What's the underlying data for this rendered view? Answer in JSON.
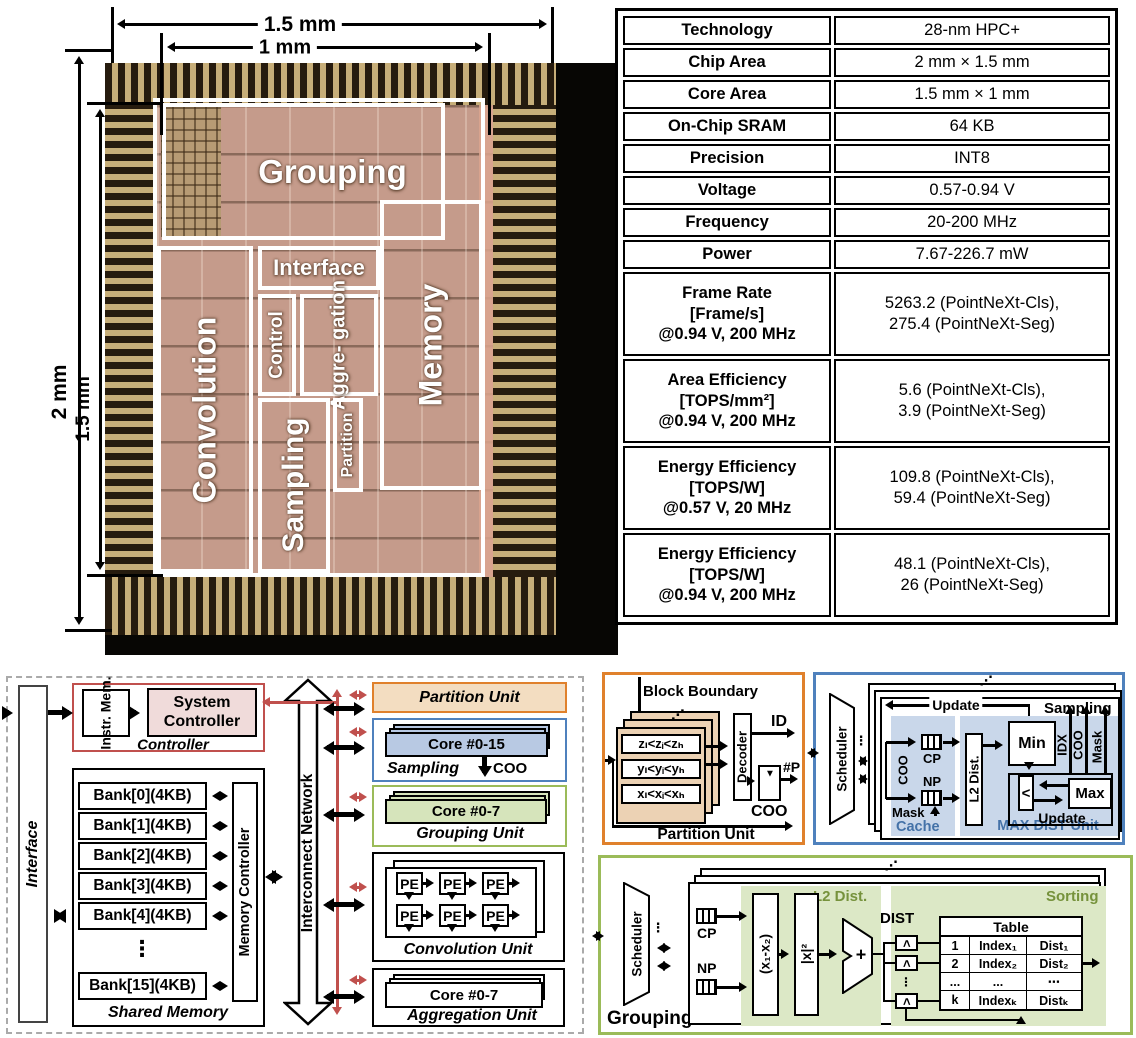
{
  "colors": {
    "red": "#c0504d",
    "orange": "#e0812c",
    "blue": "#4f81bd",
    "green": "#9bbb59",
    "tan_fill": "#ecd2b4",
    "partition_fill": "#f3ddc1",
    "blue_fill": "#b8c9e3",
    "green_fill": "#d6e4bb",
    "pink_fill": "#f0dbda",
    "shade_blue": "#c9d7ea",
    "shade_green": "#dce8c6",
    "label_green": "#76923c",
    "label_blue": "#4472a8"
  },
  "die_photo": {
    "dim_top_outer": "1.5 mm",
    "dim_top_inner": "1 mm",
    "dim_left_outer": "2 mm",
    "dim_left_inner": "1.5 mm",
    "regions": {
      "grouping": "Grouping",
      "interface": "Interface",
      "control": "Control",
      "aggregation": "Aggre-\ngation",
      "convolution": "Convolution",
      "sampling": "Sampling",
      "partition": "Partition",
      "memory": "Memory"
    }
  },
  "spec_table": {
    "rows": [
      {
        "label": "Technology",
        "value": "28-nm HPC+"
      },
      {
        "label": "Chip Area",
        "value": "2 mm × 1.5 mm"
      },
      {
        "label": "Core Area",
        "value": "1.5 mm × 1 mm"
      },
      {
        "label": "On-Chip SRAM",
        "value": "64 KB"
      },
      {
        "label": "Precision",
        "value": "INT8"
      },
      {
        "label": "Voltage",
        "value": "0.57-0.94 V"
      },
      {
        "label": "Frequency",
        "value": "20-200 MHz"
      },
      {
        "label": "Power",
        "value": "7.67-226.7 mW"
      },
      {
        "label": "Frame Rate\n[Frame/s]\n@0.94 V, 200 MHz",
        "value": "5263.2 (PointNeXt-Cls),\n275.4 (PointNeXt-Seg)"
      },
      {
        "label": "Area Efficiency\n[TOPS/mm²]\n@0.94 V, 200 MHz",
        "value": "5.6 (PointNeXt-Cls),\n3.9 (PointNeXt-Seg)"
      },
      {
        "label": "Energy Efficiency\n[TOPS/W]\n@0.57 V, 20 MHz",
        "value": "109.8 (PointNeXt-Cls),\n59.4 (PointNeXt-Seg)"
      },
      {
        "label": "Energy Efficiency\n[TOPS/W]\n@0.94 V, 200 MHz",
        "value": "48.1 (PointNeXt-Cls),\n26 (PointNeXt-Seg)"
      }
    ]
  },
  "arch": {
    "interface": "Interface",
    "controller": {
      "instr_mem": "Instr.\nMem.",
      "system_controller": "System\nController",
      "label": "Controller"
    },
    "shared_memory": {
      "banks": [
        "Bank[0](4KB)",
        "Bank[1](4KB)",
        "Bank[2](4KB)",
        "Bank[3](4KB)",
        "Bank[4](4KB)"
      ],
      "dots": "⋮",
      "last_bank": "Bank[15](4KB)",
      "memory_controller": "Memory Controller",
      "label": "Shared Memory"
    },
    "interconnect": "Interconnect Network",
    "partition_unit": "Partition Unit",
    "sampling": {
      "core": "Core #0-15",
      "label": "Sampling",
      "coo": "COO"
    },
    "grouping": {
      "core": "Core #0-7",
      "label": "Grouping Unit"
    },
    "convolution": {
      "pe": "PE",
      "label": "Convolution Unit"
    },
    "aggregation": {
      "core": "Core #0-7",
      "label": "Aggregation Unit"
    }
  },
  "partition_detail": {
    "title": "Block Boundary",
    "card_dots": "⋰",
    "rows": [
      "zₗ<zᵢ<zₕ",
      "yₗ<yᵢ<yₕ",
      "xₗ<xᵢ<xₕ"
    ],
    "decoder": "Decoder",
    "mid_dots": "⋮",
    "id": "ID",
    "hash_p": "#P",
    "tri": "▼",
    "coo": "COO",
    "label": "Partition Unit"
  },
  "sampling_detail": {
    "scheduler": "Scheduler",
    "dots": "⋮",
    "card_dots": "⋰",
    "update_top": "Update",
    "title": "Sampling",
    "coo": "COO",
    "cp": "CP",
    "np": "NP",
    "mask": "Mask",
    "cache_label": "Cache",
    "l2": "L2 Dist.",
    "min": "Min",
    "lt": "<",
    "max": "Max",
    "update_inner": "Update",
    "maxdist_label": "MAX DIST Unit",
    "out_idx": "IDX",
    "out_coo": "COO",
    "out_mask": "Mask"
  },
  "grouping_detail": {
    "scheduler": "Scheduler",
    "dots": "⋮",
    "card_dots": "⋰",
    "label": "Grouping",
    "cp": "CP",
    "np": "NP",
    "l2_label": "L2 Dist.",
    "sub": "(x₁-x₂)",
    "sq": "|x|²",
    "plus": "+",
    "dist": "DIST",
    "lt": "<",
    "cmp_dots": "⋮",
    "sorting_label": "Sorting",
    "table_title": "Table",
    "table_rows": [
      [
        "1",
        "Index₁",
        "Dist₁"
      ],
      [
        "2",
        "Index₂",
        "Dist₂"
      ],
      [
        "...",
        "...",
        "⋯"
      ],
      [
        "k",
        "Indexₖ",
        "Distₖ"
      ]
    ]
  }
}
